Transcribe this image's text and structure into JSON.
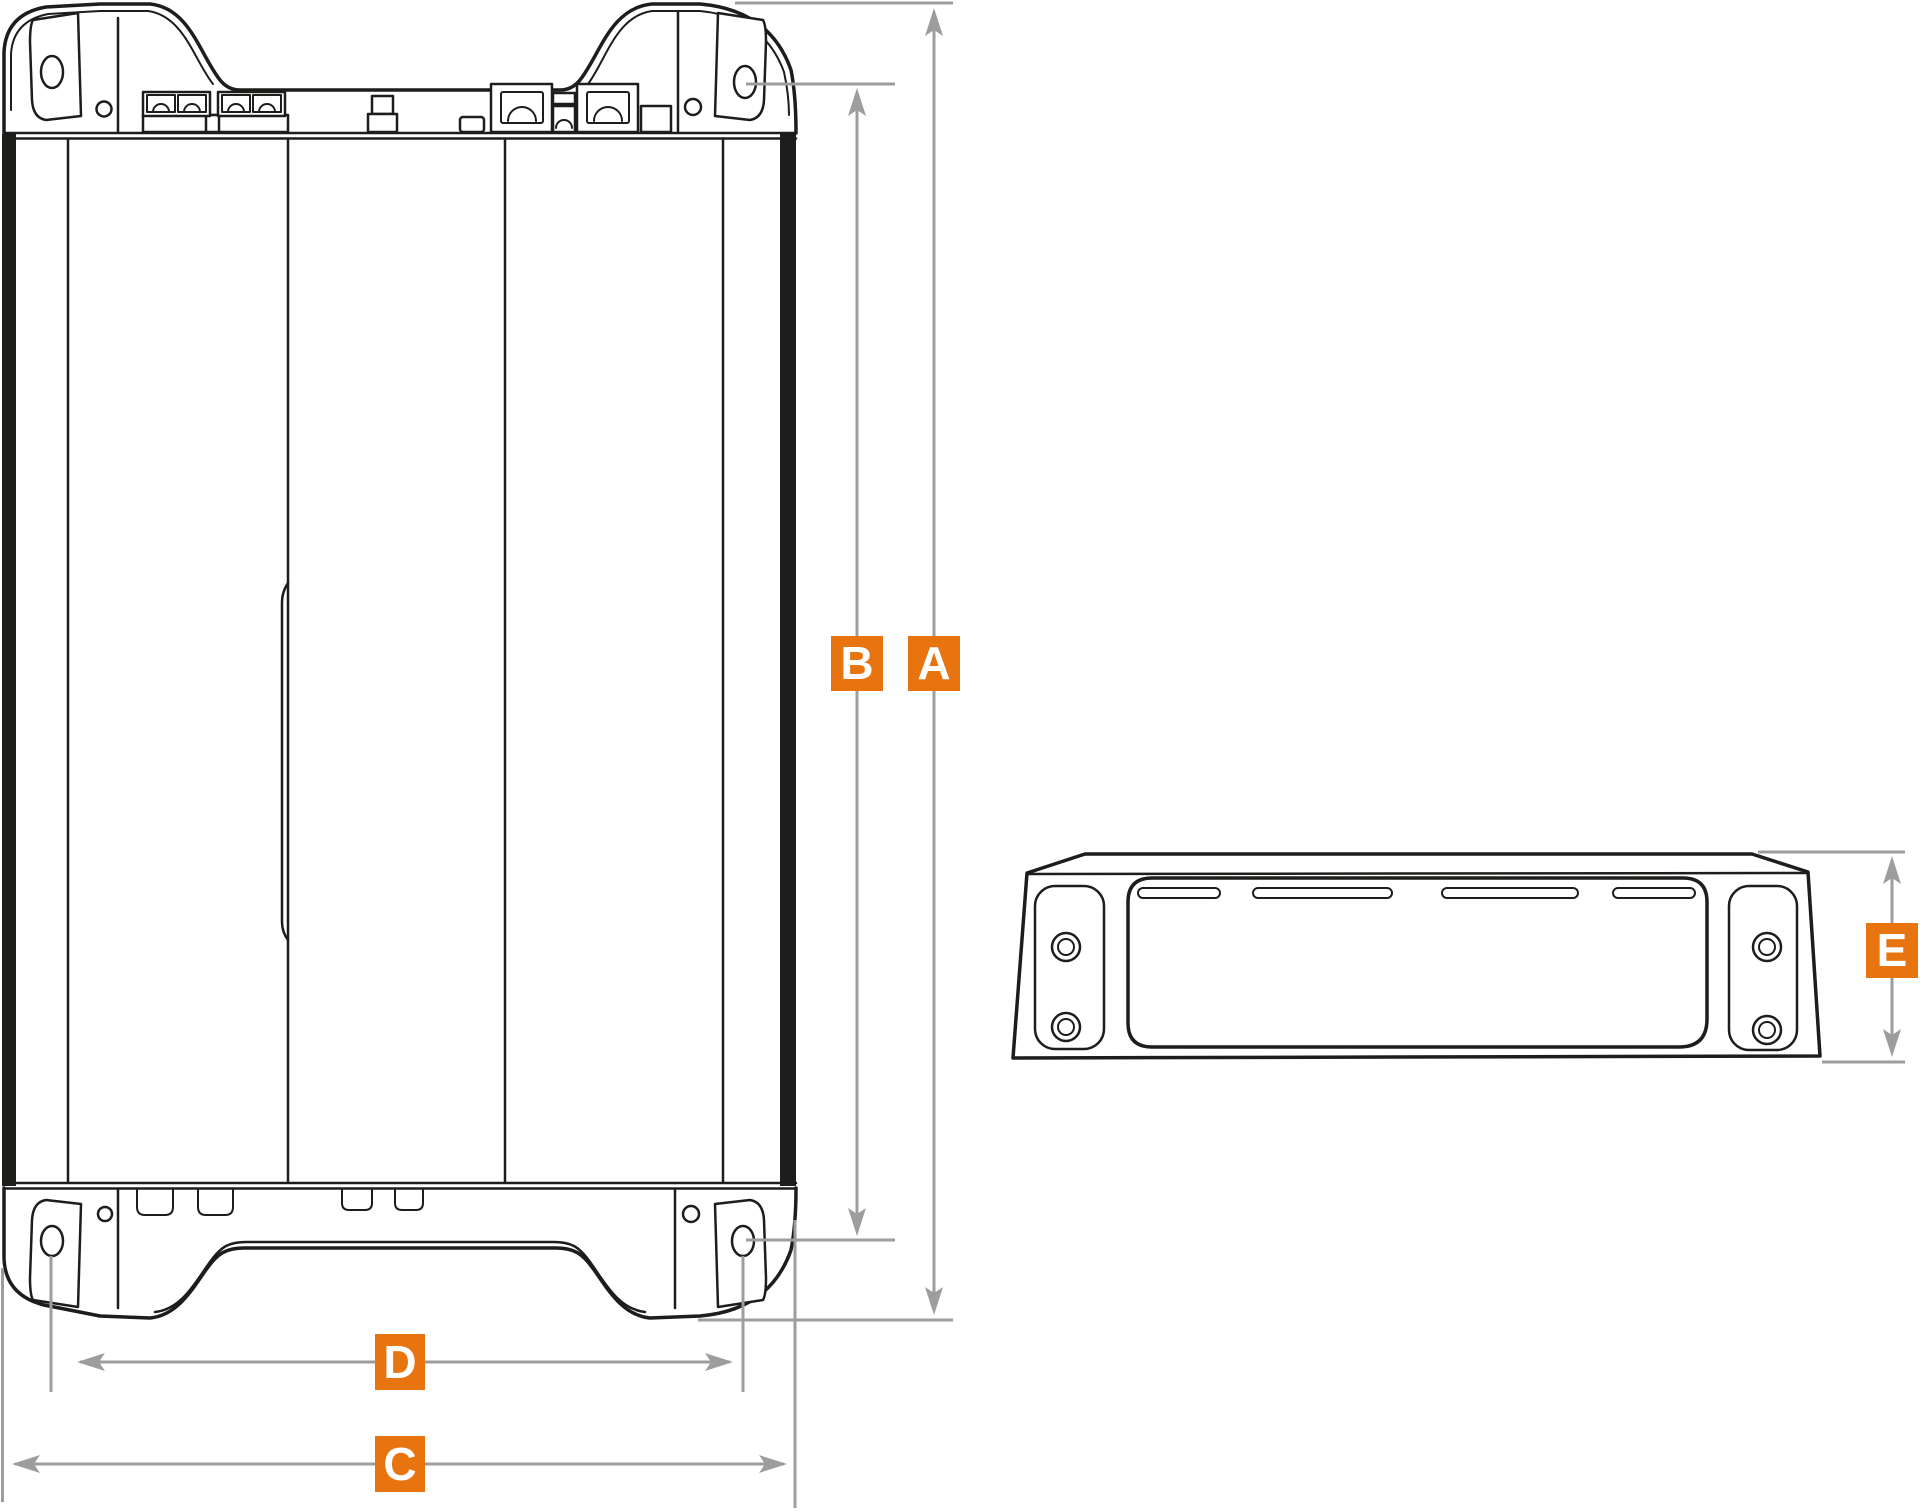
{
  "drawing": {
    "type": "technical-dimension-diagram",
    "views": {
      "top_view": "amplifier top view",
      "side_view": "amplifier side view"
    }
  },
  "labels": {
    "a": "A",
    "b": "B",
    "c": "C",
    "d": "D",
    "e": "E"
  },
  "colors": {
    "background": "#ffffff",
    "outline_black": "#1d1d1b",
    "dimension_gray": "#9d9d9c",
    "accent_orange": "#e8740f",
    "label_letter": "#ffffff"
  }
}
